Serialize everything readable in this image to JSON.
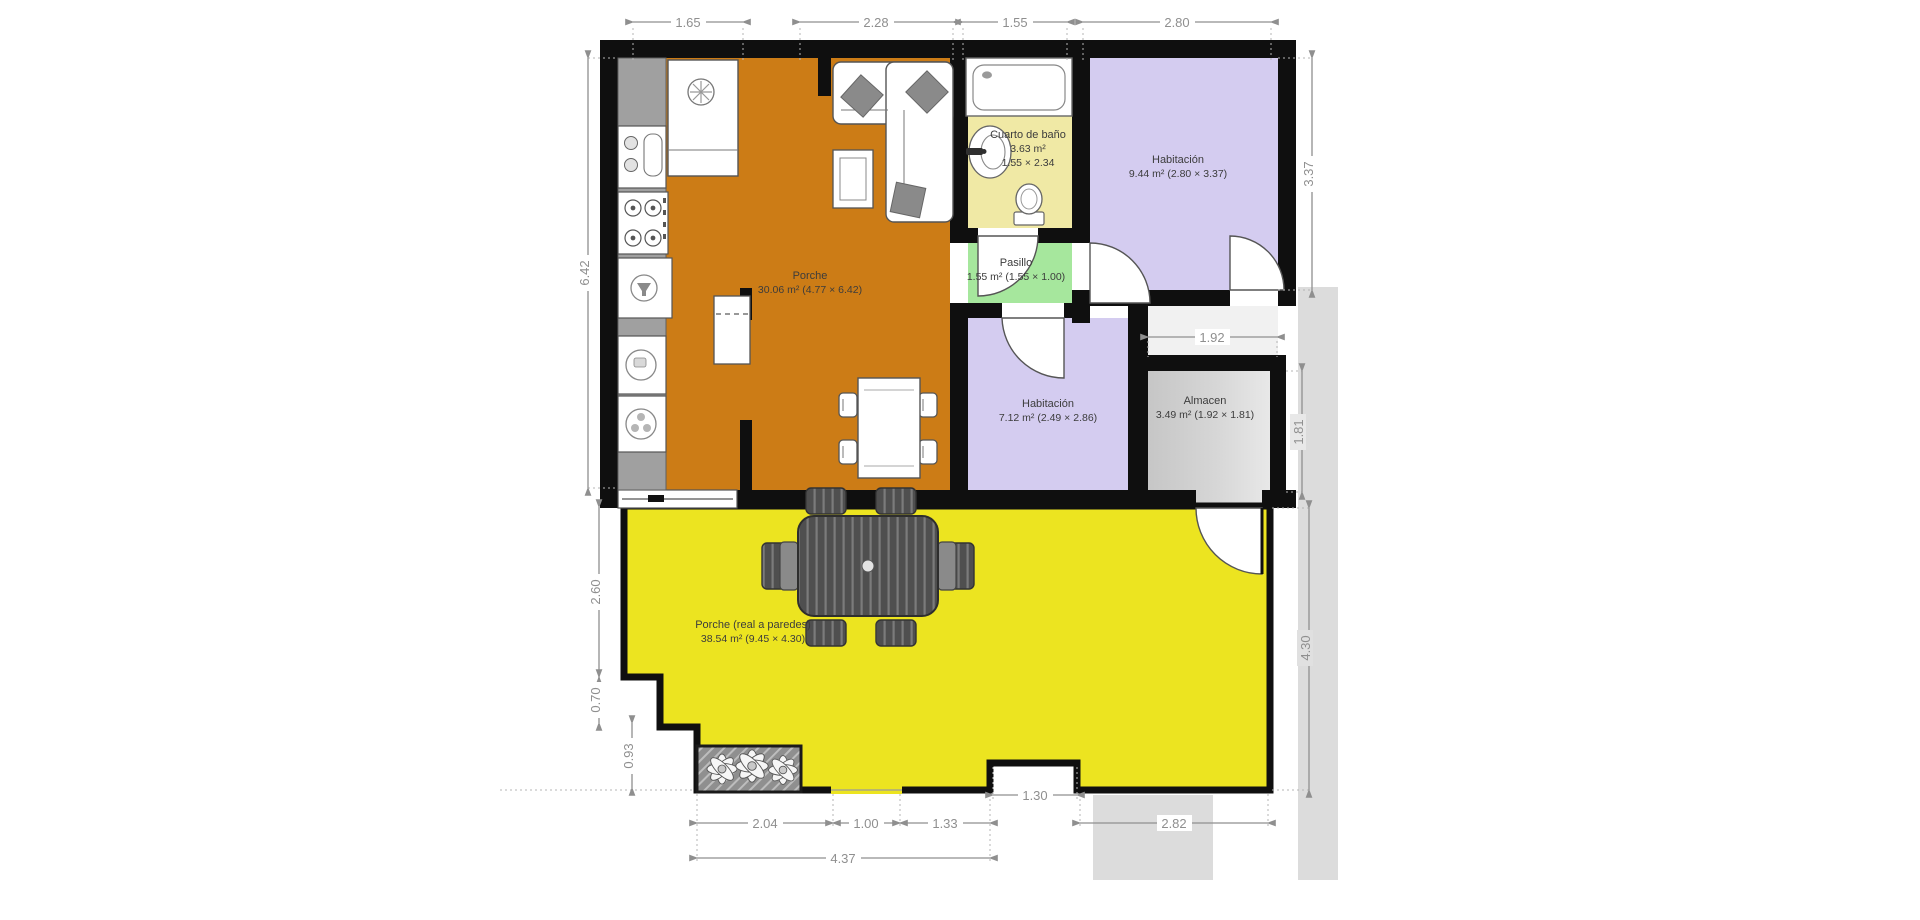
{
  "plan": {
    "rooms": [
      {
        "id": "porche-interior",
        "name": "Porche",
        "area": "30.06 m² (4.77 × 6.42)"
      },
      {
        "id": "cuarto-de-bano",
        "name": "Cuarto de baño",
        "area": "3.63 m²",
        "size": "1.55 × 2.34"
      },
      {
        "id": "habitacion-1",
        "name": "Habitación",
        "area": "9.44 m² (2.80 × 3.37)"
      },
      {
        "id": "pasillo",
        "name": "Pasillo",
        "area": "1.55 m² (1.55 × 1.00)"
      },
      {
        "id": "habitacion-2",
        "name": "Habitación",
        "area": "7.12 m² (2.49 × 2.86)"
      },
      {
        "id": "almacen",
        "name": "Almacen",
        "area": "3.49 m² (1.92 × 1.81)"
      },
      {
        "id": "porche-exterior",
        "name": "Porche (real a paredes)",
        "area": "38.54 m² (9.45 × 4.30)"
      }
    ],
    "dimensions": {
      "top": [
        "1.65",
        "2.28",
        "1.55",
        "2.80"
      ],
      "left": [
        "6.42",
        "2.60",
        "0.70",
        "0.93"
      ],
      "right": [
        "3.37",
        "1.92",
        "1.81",
        "4.30"
      ],
      "bottom": [
        "2.04",
        "1.00",
        "1.33",
        "1.30",
        "2.82",
        "4.37"
      ]
    },
    "colors": {
      "porche_interior": "#cc7c16",
      "porche_exterior": "#ece420",
      "bathroom": "#f0e9a5",
      "bedroom": "#d4ccf0",
      "pasillo": "#a6e79d",
      "almacen_dark": "#c6c6c6",
      "almacen_light": "#e8e8e8",
      "walls": "#0f0f0f",
      "dimension": "#8f8f8f",
      "exterior_band": "#dcdcdc"
    }
  }
}
